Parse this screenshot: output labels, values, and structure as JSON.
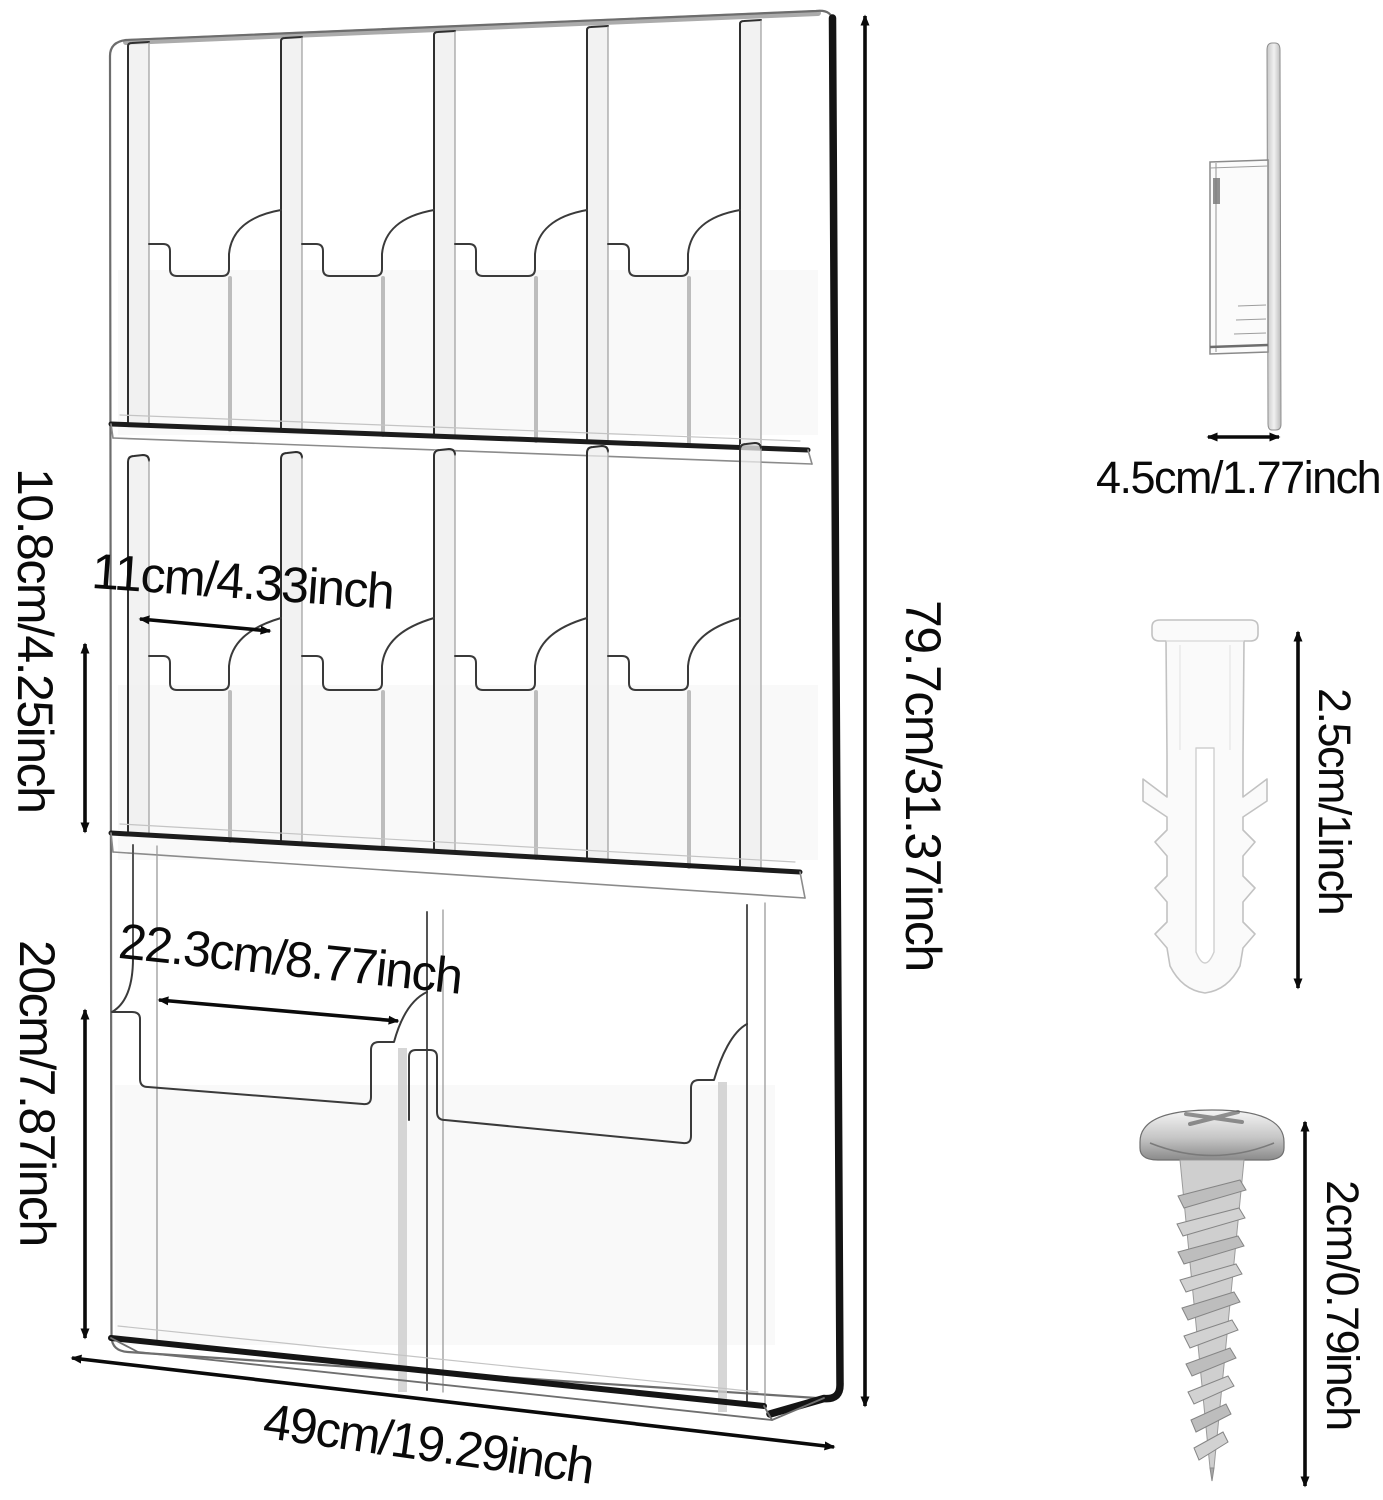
{
  "diagram": {
    "type": "product-dimension-diagram",
    "product": "wall-mount acrylic brochure holder",
    "dims": {
      "small_pocket_width": "11cm/4.33inch",
      "small_pocket_lip_height": "10.8cm/4.25inch",
      "large_pocket_width": "22.3cm/8.77inch",
      "large_pocket_lip_height": "20cm/7.87inch",
      "board_height": "79.7cm/31.37inch",
      "board_width": "49cm/19.29inch",
      "side_depth": "4.5cm/1.77inch",
      "anchor_length": "2.5cm/1inch",
      "screw_length": "2cm/0.79inch"
    },
    "colors": {
      "line_art": "#1a1a1a",
      "acrylic_edge": "#8a8a8a",
      "anchor_white": "#f8f8f8",
      "screw_silver": "#b9b9b9"
    }
  }
}
